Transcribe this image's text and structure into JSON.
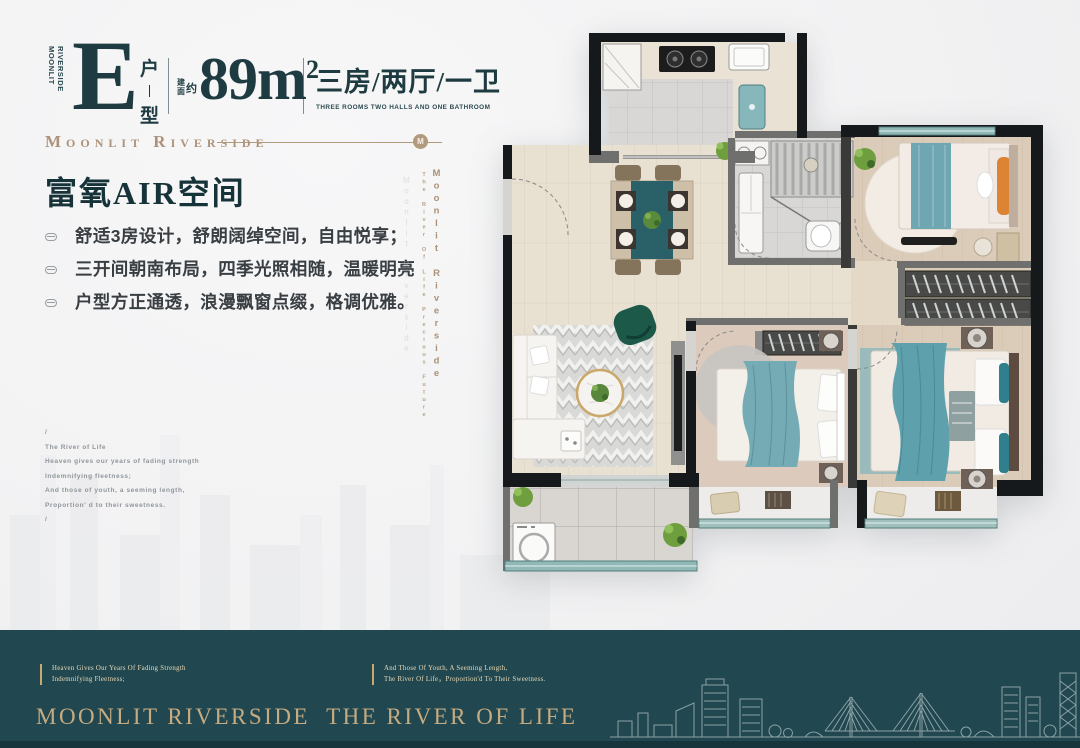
{
  "colors": {
    "ink_teal": "#1e3b41",
    "gold": "#b29a7e",
    "band_teal": "#214750",
    "window_teal": "#8fb8b6",
    "bed_teal": "#6ea7b2",
    "plan_wall": "#16191b",
    "plan_wood": "#e8e0d1",
    "plan_bedroom_wood": "#dbccb9"
  },
  "header": {
    "brand_line1": "MOONLIT",
    "brand_line2": "RIVERSIDE",
    "unit_letter": "E",
    "unit_char_top": "户",
    "unit_char_bottom": "型",
    "area_prefix_1": "建",
    "area_prefix_2": "面",
    "area_prefix_3": "约",
    "area_value": "89m",
    "area_sup": "2",
    "layout_cn": "三房/两厅/一卫",
    "layout_en": "THREE ROOMS TWO HALLS AND ONE BATHROOM"
  },
  "brand_row": {
    "title": "Moonlit Riverside",
    "badge": "M"
  },
  "headline": "富氧AIR空间",
  "bullets": [
    "舒适3房设计，舒朗阔绰空间，自由悦享；",
    "三开间朝南布局，四季光照相随，温暖明亮",
    "户型方正通透，浪漫飘窗点缀，格调优雅。"
  ],
  "poem": {
    "l0": "/",
    "l1": "The River of Life",
    "l2": "Heaven gives our years of fading strength",
    "l3": "Indemnifying fleetness;",
    "l4": "And those of youth, a seeming length,",
    "l5": "Proportion' d to their sweetness.",
    "l6": "/"
  },
  "side_watermark": {
    "small": "The River Of Life Precious Future",
    "large": "Moonlit Riverside"
  },
  "footer": {
    "col1_line1": "Heaven Gives Our Years Of Fading Strength",
    "col1_line2": "Indemnifying Fleetness;",
    "col2_line1": "And Those Of Youth, A Seeming Length,",
    "col2_line2": "The River Of Life，Proportion'd To Their Sweetness.",
    "slogan": "MOONLIT RIVERSIDE  THE RIVER OF LIFE"
  }
}
